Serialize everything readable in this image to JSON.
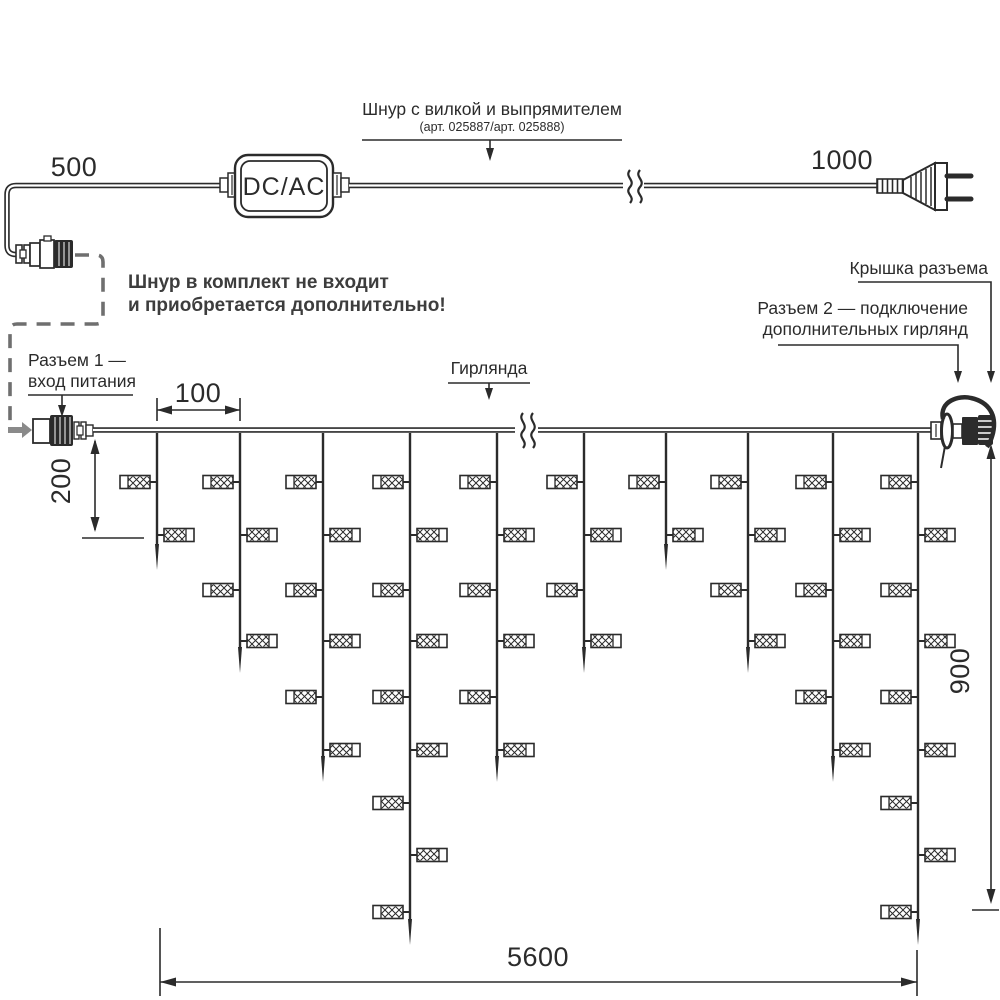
{
  "colors": {
    "ink": "#2b2b2b",
    "dash_gray": "#6f6f6f",
    "arrow_gray": "#8a8a8a",
    "background": "#ffffff"
  },
  "power_cord": {
    "length_left": "500",
    "length_right": "1000",
    "adapter_label": "DC/AC",
    "callout_title": "Шнур с вилкой и выпрямителем",
    "callout_sub": "(арт. 025887/арт. 025888)",
    "note_line1": "Шнур в комплект не входит",
    "note_line2": "и приобретается дополнительно!"
  },
  "garland": {
    "name_label": "Гирлянда",
    "connector1_line1": "Разъем 1 —",
    "connector1_line2": "вход питания",
    "connector2_line1": "Разъем 2 — подключение",
    "connector2_line2": "дополнительных гирлянд",
    "cover_label": "Крышка разъема",
    "dims": {
      "drop_spacing": "100",
      "first_drop": "200",
      "height": "900",
      "total_length": "5600"
    },
    "wire_y": 430,
    "drops": [
      {
        "x": 157,
        "lamps": 2
      },
      {
        "x": 240,
        "lamps": 4
      },
      {
        "x": 323,
        "lamps": 6
      },
      {
        "x": 410,
        "lamps": 9
      },
      {
        "x": 497,
        "lamps": 6
      },
      {
        "x": 584,
        "lamps": 4
      },
      {
        "x": 666,
        "lamps": 2
      },
      {
        "x": 748,
        "lamps": 4
      },
      {
        "x": 833,
        "lamps": 6
      },
      {
        "x": 918,
        "lamps": 9
      }
    ],
    "lamp_levels": [
      482,
      535,
      590,
      641,
      697,
      750,
      803,
      855,
      912
    ],
    "tip_y": {
      "2": 570,
      "4": 673,
      "6": 782,
      "9": 945
    }
  }
}
